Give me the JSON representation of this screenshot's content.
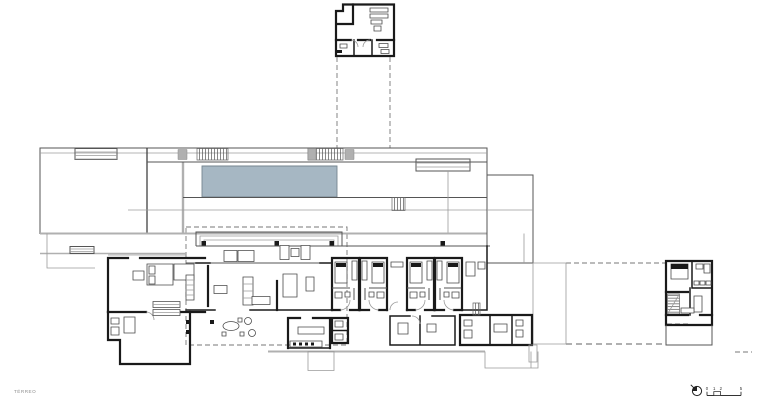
{
  "plan": {
    "colors": {
      "background": "#ffffff",
      "wall": "#1a1a1a",
      "line-medium": "#555555",
      "line-light": "#9b9b9b",
      "dash": "#777777",
      "pool-fill": "#a6b7c3",
      "pool-stroke": "#76868f",
      "platform": "#b0b0b0",
      "text": "#333333",
      "label": "#8d8d8d"
    }
  },
  "footer": {
    "floor_label": "TÉRREO",
    "compass_icon": "north-arrow",
    "scalebar": {
      "tick0": "0",
      "tick1": "1",
      "tick2": "2",
      "tick5": "5"
    }
  }
}
